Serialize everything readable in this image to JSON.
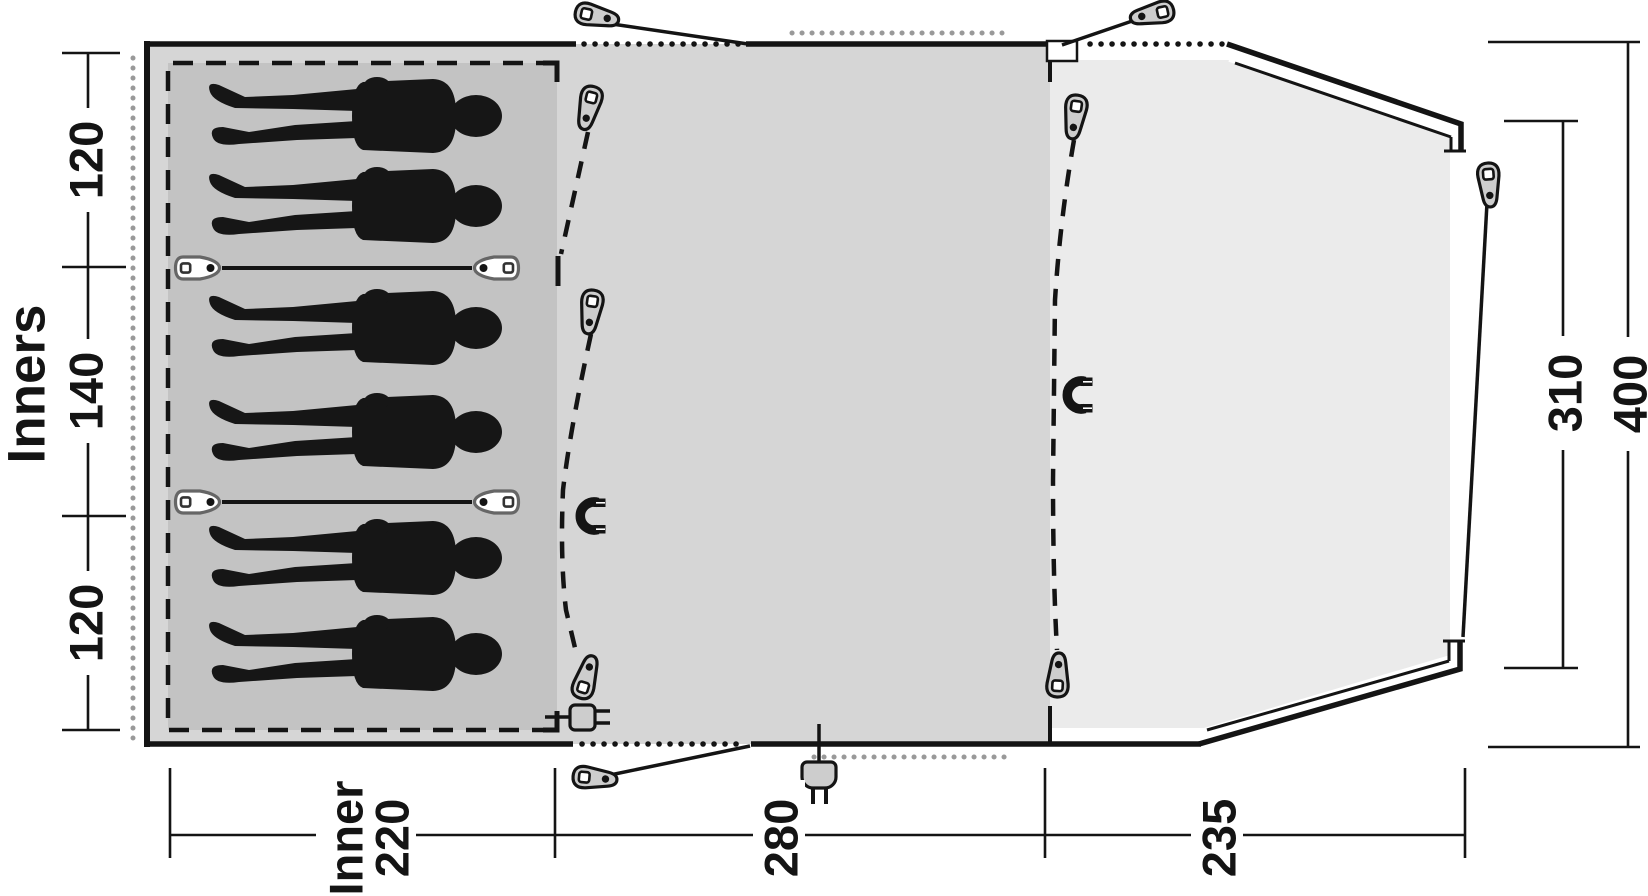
{
  "diagram_title": "",
  "dimensions": {
    "left": {
      "axis_label": "Inners",
      "sections": [
        "120",
        "140",
        "120"
      ]
    },
    "bottom": {
      "sections": [
        {
          "name": "inner-bedroom-width",
          "lines": [
            "Inner",
            "220"
          ]
        },
        {
          "name": "living-room-width",
          "lines": [
            "280"
          ]
        },
        {
          "name": "front-porch-width",
          "lines": [
            "235"
          ]
        }
      ]
    },
    "right": {
      "sections": [
        "310",
        "400"
      ]
    }
  },
  "areas": {
    "sleeping_area": {
      "sleeper_count": 6,
      "bed_bays": 3
    },
    "living_area": {},
    "porch_area": {}
  },
  "icons": {
    "zipper_pull": "teardrop slider with square eyelet and pin dot",
    "guy_peg": "teardrop peg on guy line",
    "bed_toggle": "tie-back toggle with square eyelet",
    "magnet": "magnetic door catch (horseshoe)",
    "power_plug": "mains plug with two pins",
    "cable_entry": "cable entry plug"
  },
  "colors": {
    "sleeping_area": "#c3c3c3",
    "living_area": "#d6d6d6",
    "porch_area": "#ebebeb",
    "outline": "#141414",
    "groundsheet_dots": "#999999",
    "label_text": "#141414"
  }
}
